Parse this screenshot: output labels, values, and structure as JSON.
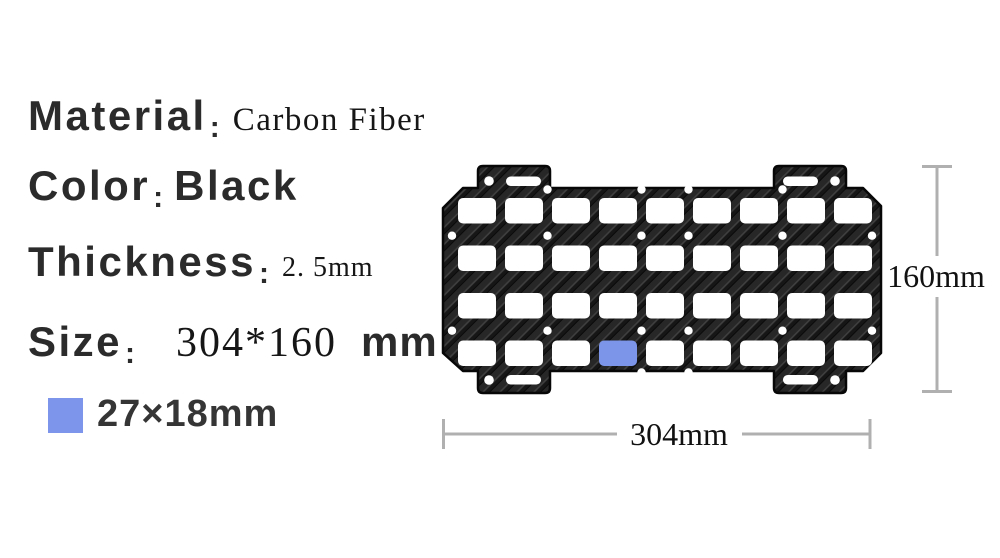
{
  "specs": [
    {
      "label": "Material",
      "colon": ":",
      "value": "Carbon Fiber"
    },
    {
      "label": "Color",
      "colon": ":",
      "value": "Black"
    },
    {
      "label": "Thickness",
      "colon": ":",
      "value": "2. 5mm"
    },
    {
      "label": "Size",
      "colon": ":",
      "value": "304*160",
      "unit": "mm"
    }
  ],
  "legend": {
    "label": "27×18mm",
    "swatch_color": "#7e95ec"
  },
  "dimensions": {
    "height_label": "160mm",
    "width_label": "304mm"
  },
  "panel": {
    "rows": 4,
    "cols": 9,
    "highlight": {
      "row": 4,
      "col": 4
    },
    "cutout_color": "#ffffff",
    "highlight_color": "#7c95e9",
    "base_color": "#181818"
  },
  "colors": {
    "label_text": "#2b2b2b",
    "dim_line": "#b0b0b0",
    "dim_text": "#111111"
  }
}
